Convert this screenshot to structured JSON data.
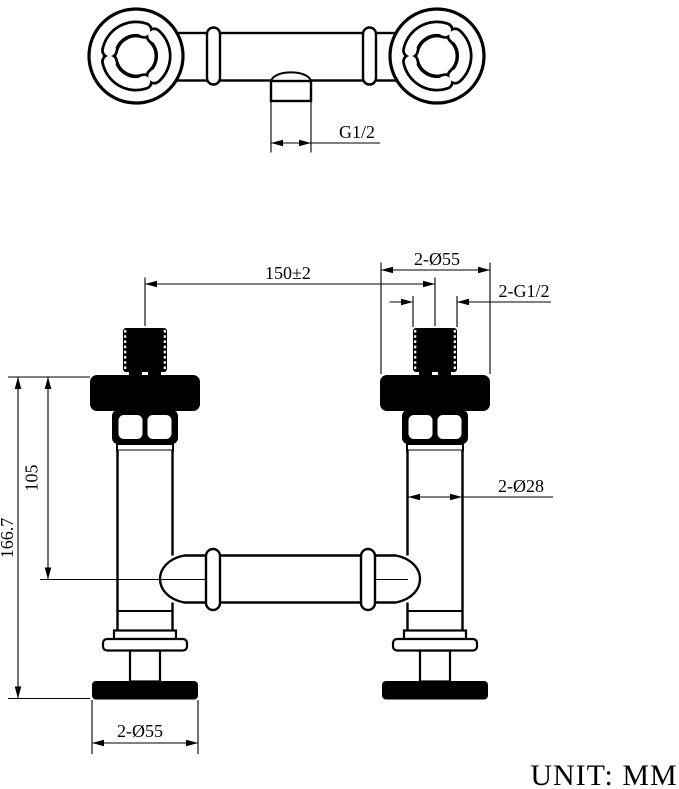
{
  "drawing": {
    "title": "valve faucet technical drawing",
    "unit_note": "UNIT: MM",
    "colors": {
      "ink": "#000000",
      "paper": "#ffffff"
    },
    "top_view": {
      "outlet_thread_dim": "G1/2"
    },
    "front_view": {
      "handle_centers_dim": "150±2",
      "flange_dia_dim": "2-Ø55",
      "inlet_thread_dim": "2-G1/2",
      "body_dia_dim": "2-Ø28",
      "base_dia_dim": "2-Ø55",
      "total_height_dim": "166.7",
      "center_height_dim": "105"
    }
  }
}
